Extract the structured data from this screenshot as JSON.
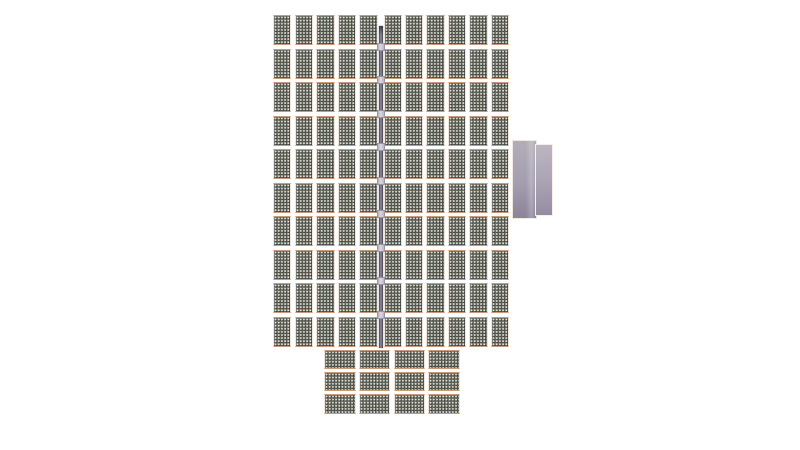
{
  "scene": {
    "description": "Top-down render of a solar photovoltaic array system on a white background",
    "background_color": "#ffffff"
  },
  "components": {
    "main_array": {
      "label": "Main PV array",
      "rows": 10,
      "left_columns": 5,
      "right_columns": 6,
      "panel_count": 110,
      "panel_orientation": "portrait"
    },
    "bottom_array": {
      "label": "Lower PV array",
      "rows": 3,
      "columns": 4,
      "panel_count": 12,
      "panel_orientation": "landscape"
    },
    "rail": {
      "label": "Central mounting rail",
      "clamp_count": 9
    },
    "inverter": {
      "label": "Inverter box"
    }
  },
  "colors": {
    "background": "#ffffff",
    "panel_cell": "#2e312b",
    "panel_grid_dot": "#f0f0e4",
    "panel_frame": "#f0e6dd",
    "panel_frame_accent": "#c89a7c",
    "rail_dark": "#474250",
    "rail_light": "#928c9e",
    "clamp": "#dcd9e2",
    "inverter_top": "#b2aeb8",
    "inverter_bottom": "#8b8397",
    "inverter_trim": "#f8f0e8"
  }
}
